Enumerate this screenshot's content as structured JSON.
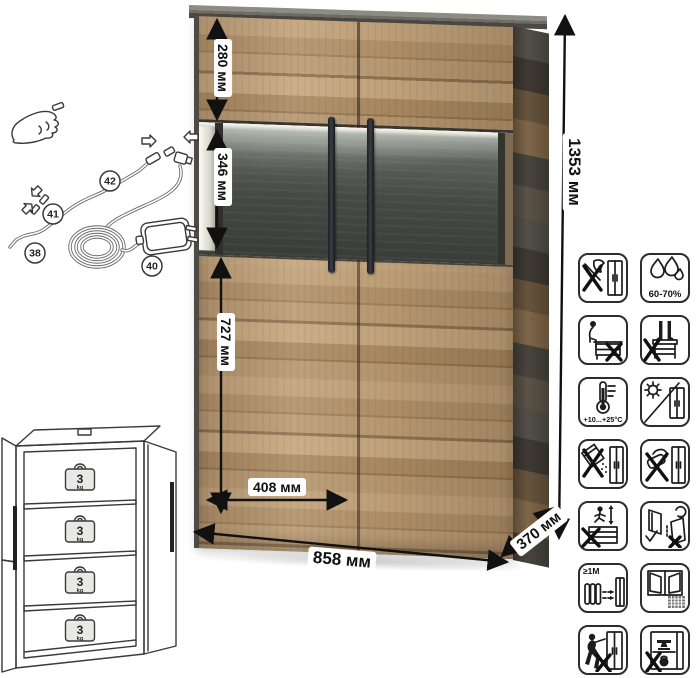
{
  "dimensions": {
    "upper_section_height": "280 мм",
    "glass_section_height": "346 мм",
    "lower_section_height": "727 мм",
    "door_width": "408 мм",
    "width": "858 мм",
    "depth": "370 мм",
    "height": "1353 мм"
  },
  "led_kit": {
    "parts": {
      "p38": "38",
      "p40": "40",
      "p41": "41",
      "p42": "42"
    }
  },
  "shelves": {
    "count": 4,
    "load_value": "3",
    "load_unit": "kg"
  },
  "care_icons": [
    {
      "name": "no-sharp-tools",
      "text": ""
    },
    {
      "name": "humidity-range",
      "text": "60-70%"
    },
    {
      "name": "no-sitting",
      "text": ""
    },
    {
      "name": "no-standing",
      "text": ""
    },
    {
      "name": "temperature-range",
      "text": "+10...+25°C"
    },
    {
      "name": "avoid-direct-sunlight",
      "text": ""
    },
    {
      "name": "no-abrasive-cleaners",
      "text": ""
    },
    {
      "name": "no-harsh-scrubbing",
      "text": ""
    },
    {
      "name": "no-jumping-on-furniture",
      "text": ""
    },
    {
      "name": "keep-upright-adjust-doors",
      "text": ""
    },
    {
      "name": "heat-source-distance",
      "text": "≥1М"
    },
    {
      "name": "ventilate-room",
      "text": ""
    },
    {
      "name": "no-dragging",
      "text": ""
    },
    {
      "name": "no-overloading",
      "text": ""
    }
  ]
}
